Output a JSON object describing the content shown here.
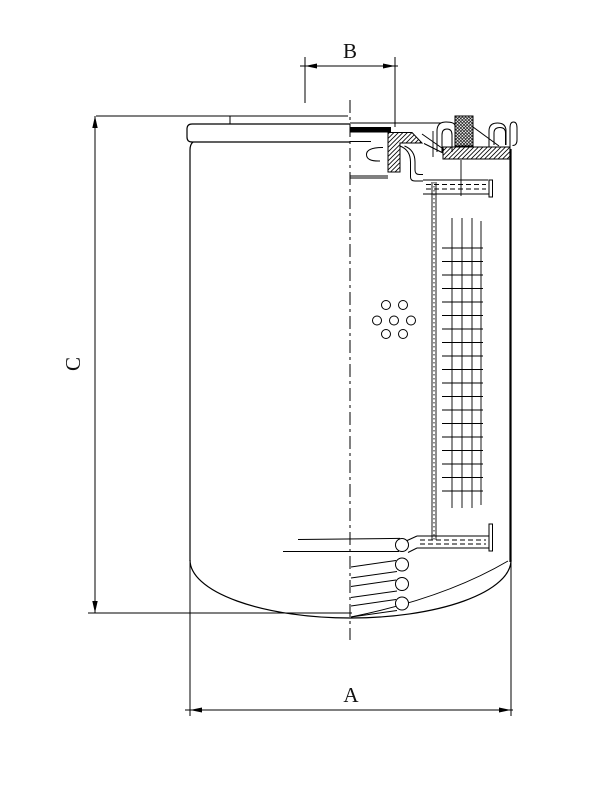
{
  "page": {
    "background": "#ffffff",
    "line_color": "#000000"
  },
  "drawing": {
    "kind": "spin-on-filter-cross-section",
    "dimensions": [
      {
        "id": "A",
        "label": "A",
        "orientation": "horizontal",
        "position": "bottom-overall-diameter"
      },
      {
        "id": "B",
        "label": "B",
        "orientation": "horizontal",
        "position": "top-thread-diameter"
      },
      {
        "id": "C",
        "label": "C",
        "orientation": "vertical",
        "position": "left-overall-height"
      }
    ]
  }
}
